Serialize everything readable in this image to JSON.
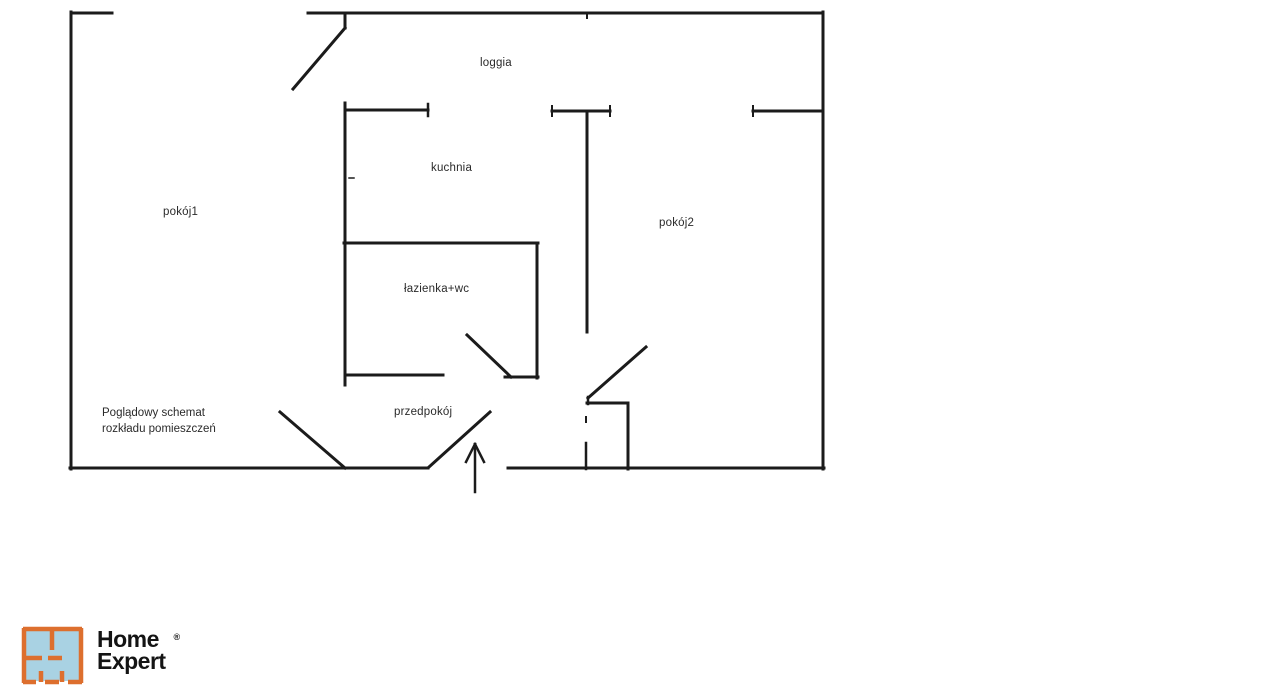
{
  "page": {
    "background": "#ffffff",
    "type_note": "apartment floor plan schematic"
  },
  "floorplan": {
    "line_color": "#1b1b1b",
    "labels": [
      {
        "id": "loggia",
        "text": "loggia"
      },
      {
        "id": "kuchnia",
        "text": "kuchnia"
      },
      {
        "id": "pokoj1",
        "text": "pokój1"
      },
      {
        "id": "pokoj2",
        "text": "pokój2"
      },
      {
        "id": "lazienka",
        "text": "łazienka+wc"
      },
      {
        "id": "przedpokoj",
        "text": "przedpokój"
      }
    ],
    "caption": {
      "line1": "Poglądowy schemat",
      "line2": "rozkładu pomieszczeń"
    },
    "segments": [
      {
        "name": "outer-wall-top-left",
        "x1": 71,
        "y1": 13,
        "x2": 112,
        "y2": 13
      },
      {
        "name": "outer-wall-top",
        "x1": 308,
        "y1": 13,
        "x2": 823,
        "y2": 13
      },
      {
        "name": "outer-wall-left",
        "x1": 71,
        "y1": 12,
        "x2": 71,
        "y2": 469
      },
      {
        "name": "outer-wall-right",
        "x1": 823,
        "y1": 12,
        "x2": 823,
        "y2": 469
      },
      {
        "name": "outer-wall-bottom-left",
        "x1": 70,
        "y1": 468,
        "x2": 428,
        "y2": 468
      },
      {
        "name": "outer-wall-bottom-right",
        "x1": 508,
        "y1": 468,
        "x2": 824,
        "y2": 468
      },
      {
        "name": "top-wall-notch",
        "x1": 587,
        "y1": 13,
        "x2": 587,
        "y2": 18,
        "w": 2
      },
      {
        "name": "loggia-wall-kuchnia-top",
        "x1": 345,
        "y1": 110,
        "x2": 428,
        "y2": 110
      },
      {
        "name": "loggia-wall-kuchnia-tick",
        "x1": 428,
        "y1": 104,
        "x2": 428,
        "y2": 116,
        "w": 2.5
      },
      {
        "name": "loggia-wall-middle",
        "x1": 552,
        "y1": 111,
        "x2": 610,
        "y2": 111
      },
      {
        "name": "loggia-wall-middle-tick-l",
        "x1": 552,
        "y1": 106,
        "x2": 552,
        "y2": 116,
        "w": 2
      },
      {
        "name": "loggia-wall-middle-tick-r",
        "x1": 610,
        "y1": 106,
        "x2": 610,
        "y2": 116,
        "w": 2
      },
      {
        "name": "loggia-wall-right",
        "x1": 753,
        "y1": 111,
        "x2": 823,
        "y2": 111
      },
      {
        "name": "loggia-wall-right-tick",
        "x1": 753,
        "y1": 106,
        "x2": 753,
        "y2": 116,
        "w": 2
      },
      {
        "name": "loggia-door-jamb",
        "x1": 345,
        "y1": 13,
        "x2": 345,
        "y2": 28
      },
      {
        "name": "loggia-door-swing",
        "x1": 345,
        "y1": 28,
        "x2": 293,
        "y2": 89
      },
      {
        "name": "kuchnia-wall-left",
        "x1": 345,
        "y1": 103,
        "x2": 345,
        "y2": 245
      },
      {
        "name": "kuchnia-wall-hinge-mark",
        "x1": 349,
        "y1": 178,
        "x2": 354,
        "y2": 178,
        "w": 1.5
      },
      {
        "name": "kuchnia-pokoj2-wall",
        "x1": 587,
        "y1": 111,
        "x2": 587,
        "y2": 332
      },
      {
        "name": "lazienka-wall-top",
        "x1": 344,
        "y1": 243,
        "x2": 538,
        "y2": 243
      },
      {
        "name": "lazienka-wall-left",
        "x1": 345,
        "y1": 243,
        "x2": 345,
        "y2": 385
      },
      {
        "name": "lazienka-wall-right",
        "x1": 537,
        "y1": 243,
        "x2": 537,
        "y2": 378
      },
      {
        "name": "lazienka-wall-bottom-left",
        "x1": 345,
        "y1": 375,
        "x2": 443,
        "y2": 375
      },
      {
        "name": "lazienka-wall-bottom-right",
        "x1": 505,
        "y1": 377,
        "x2": 538,
        "y2": 377
      },
      {
        "name": "lazienka-door-swing",
        "x1": 467,
        "y1": 335,
        "x2": 511,
        "y2": 377
      },
      {
        "name": "pokoj1-door-swing",
        "x1": 280,
        "y1": 412,
        "x2": 345,
        "y2": 468
      },
      {
        "name": "entrance-door-swing",
        "x1": 429,
        "y1": 467,
        "x2": 490,
        "y2": 412
      },
      {
        "name": "pokoj2-door-swing",
        "x1": 646,
        "y1": 347,
        "x2": 588,
        "y2": 398
      },
      {
        "name": "entry-nook-jamb",
        "x1": 588,
        "y1": 397,
        "x2": 588,
        "y2": 404,
        "w": 2.5
      },
      {
        "name": "entry-nook-wall-top",
        "x1": 587,
        "y1": 403,
        "x2": 628,
        "y2": 403
      },
      {
        "name": "entry-nook-wall-right",
        "x1": 628,
        "y1": 403,
        "x2": 628,
        "y2": 469
      },
      {
        "name": "entry-nook-dash",
        "x1": 586,
        "y1": 417,
        "x2": 586,
        "y2": 422,
        "w": 2
      },
      {
        "name": "entry-nook-wall-left",
        "x1": 586,
        "y1": 443,
        "x2": 586,
        "y2": 469,
        "w": 2.5
      }
    ],
    "arrow": {
      "meaning": "entrance direction arrow",
      "segments": [
        {
          "name": "arrow-shaft",
          "x1": 475,
          "y1": 492,
          "x2": 475,
          "y2": 444,
          "w": 2.5
        },
        {
          "name": "arrow-head-left",
          "x1": 475,
          "y1": 444,
          "x2": 466,
          "y2": 462,
          "w": 2.5
        },
        {
          "name": "arrow-head-right",
          "x1": 475,
          "y1": 444,
          "x2": 484,
          "y2": 462,
          "w": 2.5
        }
      ]
    }
  },
  "logo": {
    "brand_line1": "Home",
    "brand_line2": "Expert",
    "registered_mark": "®",
    "icon": "floorplan-icon",
    "colors": {
      "orange": "#dd6f2e",
      "blue": "#a9d2e3",
      "text": "#141414"
    }
  }
}
